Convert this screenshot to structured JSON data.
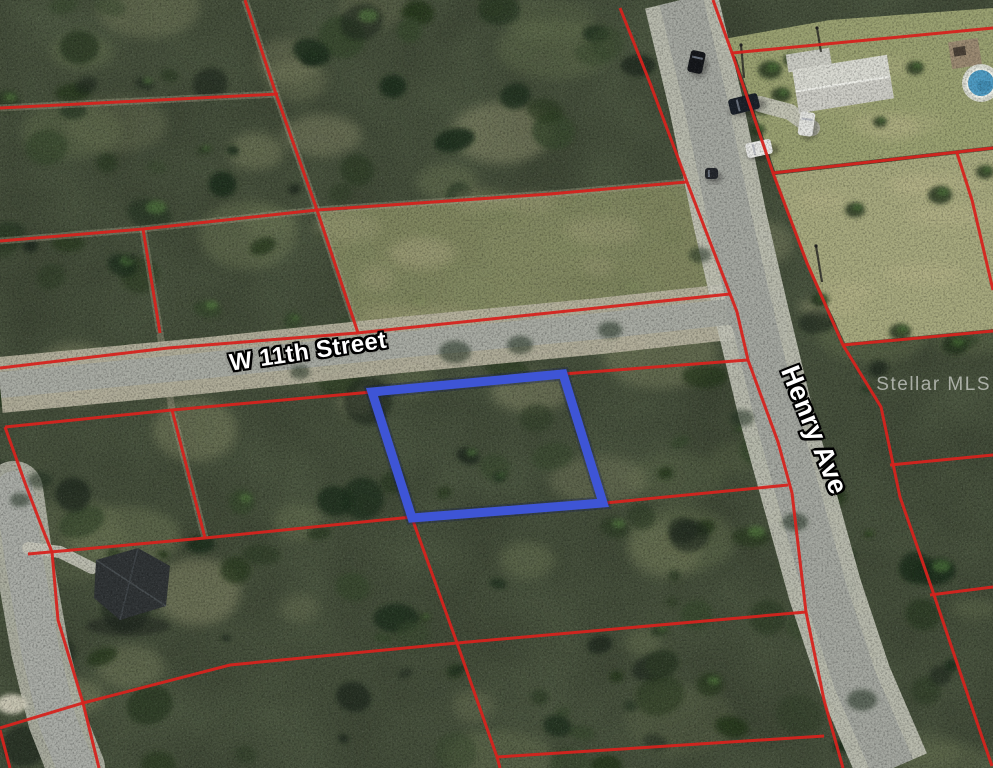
{
  "map": {
    "street_labels": [
      {
        "id": "w-11th-street",
        "text": "W 11th Street"
      },
      {
        "id": "henry-ave",
        "text": "Henry Ave"
      }
    ],
    "watermark": {
      "text": "Stellar MLS"
    },
    "colors": {
      "parcel_line": "#d6231d",
      "highlight": "#3e55d6",
      "highlight_underlay": "#101c4e",
      "forest": "#4c5741",
      "lawn": "#9aa171",
      "mowed": "#a7a97e",
      "midwest_clearing": "#8b9066",
      "pavement": "#a8aba3",
      "henry_pavement": "#a4a7a0",
      "shoulder": "#b9b4a1",
      "henry_shoulder": "#c4c5b9",
      "sw_pavement": "#a9aca6",
      "sw_shoulder": "#bcbdb0",
      "driveway": "#c6c6ba",
      "pool_water": "#4e9cc4",
      "track": "#a7a189"
    },
    "highlight_parcel": [
      [
        372,
        392
      ],
      [
        563,
        374
      ],
      [
        603,
        503
      ],
      [
        412,
        518
      ]
    ],
    "parcel_lines": [
      [
        [
          0,
          108
        ],
        [
          278,
          94
        ]
      ],
      [
        [
          245,
          0
        ],
        [
          276,
          94
        ],
        [
          317,
          210
        ],
        [
          358,
          333
        ]
      ],
      [
        [
          0,
          241
        ],
        [
          143,
          229
        ],
        [
          317,
          210
        ],
        [
          550,
          194
        ],
        [
          686,
          182
        ]
      ],
      [
        [
          143,
          229
        ],
        [
          160,
          333
        ]
      ],
      [
        [
          172,
          410
        ],
        [
          205,
          538
        ]
      ],
      [
        [
          0,
          368
        ],
        [
          168,
          348
        ],
        [
          357,
          333
        ],
        [
          730,
          294
        ]
      ],
      [
        [
          5,
          427
        ],
        [
          172,
          410
        ],
        [
          372,
          392
        ]
      ],
      [
        [
          563,
          374
        ],
        [
          748,
          360
        ]
      ],
      [
        [
          620,
          8
        ],
        [
          650,
          83
        ],
        [
          687,
          182
        ],
        [
          737,
          312
        ],
        [
          748,
          360
        ],
        [
          778,
          442
        ],
        [
          792,
          493
        ],
        [
          806,
          612
        ],
        [
          824,
          700
        ],
        [
          843,
          768
        ]
      ],
      [
        [
          28,
          554
        ],
        [
          205,
          538
        ],
        [
          412,
          517
        ]
      ],
      [
        [
          605,
          503
        ],
        [
          788,
          485
        ]
      ],
      [
        [
          5,
          427
        ],
        [
          25,
          483
        ],
        [
          43,
          530
        ],
        [
          52,
          552
        ],
        [
          58,
          620
        ],
        [
          83,
          703
        ],
        [
          99,
          768
        ]
      ],
      [
        [
          412,
          518
        ],
        [
          457,
          643
        ],
        [
          497,
          757
        ],
        [
          500,
          768
        ]
      ],
      [
        [
          0,
          728
        ],
        [
          83,
          703
        ],
        [
          230,
          665
        ],
        [
          457,
          643
        ],
        [
          806,
          612
        ]
      ],
      [
        [
          497,
          757
        ],
        [
          824,
          736
        ]
      ],
      [
        [
          713,
          0
        ],
        [
          732,
          53
        ],
        [
          773,
          173
        ],
        [
          807,
          263
        ],
        [
          843,
          345
        ],
        [
          881,
          407
        ],
        [
          900,
          497
        ],
        [
          933,
          592
        ],
        [
          983,
          740
        ],
        [
          992,
          766
        ]
      ],
      [
        [
          732,
          53
        ],
        [
          993,
          28
        ]
      ],
      [
        [
          773,
          173
        ],
        [
          993,
          148
        ]
      ],
      [
        [
          843,
          345
        ],
        [
          993,
          331
        ]
      ],
      [
        [
          890,
          465
        ],
        [
          993,
          455
        ]
      ],
      [
        [
          930,
          595
        ],
        [
          993,
          587
        ]
      ],
      [
        [
          957,
          153
        ],
        [
          972,
          200
        ],
        [
          993,
          290
        ]
      ],
      [
        [
          0,
          730
        ],
        [
          10,
          768
        ]
      ]
    ],
    "cleared_tracks": [
      [
        [
          245,
          0
        ],
        [
          276,
          94
        ],
        [
          317,
          210
        ],
        [
          358,
          333
        ]
      ],
      [
        [
          143,
          229
        ],
        [
          160,
          333
        ],
        [
          172,
          410
        ],
        [
          205,
          538
        ]
      ],
      [
        [
          0,
          108
        ],
        [
          278,
          94
        ]
      ],
      [
        [
          0,
          241
        ],
        [
          143,
          229
        ],
        [
          317,
          210
        ],
        [
          550,
          194
        ],
        [
          686,
          182
        ]
      ]
    ],
    "roads": {
      "henry": [
        [
          681,
          0
        ],
        [
          705,
          100
        ],
        [
          730,
          220
        ],
        [
          752,
          315
        ],
        [
          775,
          410
        ],
        [
          800,
          500
        ],
        [
          825,
          590
        ],
        [
          855,
          680
        ],
        [
          893,
          768
        ]
      ],
      "w11th": [
        [
          0,
          385
        ],
        [
          200,
          366
        ],
        [
          400,
          345
        ],
        [
          600,
          326
        ],
        [
          755,
          309
        ]
      ],
      "sw": [
        [
          14,
          490
        ],
        [
          24,
          560
        ],
        [
          40,
          650
        ],
        [
          57,
          720
        ],
        [
          76,
          768
        ]
      ]
    },
    "areas": {
      "lawn": [
        [
          718,
          40
        ],
        [
          830,
          20
        ],
        [
          993,
          8
        ],
        [
          993,
          146
        ],
        [
          775,
          171
        ],
        [
          736,
          57
        ]
      ],
      "mowed": [
        [
          775,
          175
        ],
        [
          993,
          150
        ],
        [
          993,
          329
        ],
        [
          845,
          343
        ],
        [
          809,
          265
        ]
      ],
      "midwest": [
        [
          319,
          212
        ],
        [
          684,
          184
        ],
        [
          728,
          293
        ],
        [
          359,
          331
        ]
      ]
    },
    "features": {
      "house_ne": {
        "cx": 843,
        "cy": 84,
        "x": 795,
        "y": 62,
        "w": 96,
        "h": 44,
        "rot": -9
      },
      "carport_ne": {
        "x": 791,
        "y": 46,
        "w": 44,
        "h": 18
      },
      "shed_ne": {
        "x": 950,
        "y": 40,
        "w": 30,
        "h": 27,
        "rot": -9
      },
      "pool": {
        "cx": 981,
        "cy": 83,
        "r": 14
      },
      "house_sw": [
        [
          96,
          560
        ],
        [
          138,
          548
        ],
        [
          170,
          566
        ],
        [
          166,
          606
        ],
        [
          120,
          620
        ],
        [
          94,
          598
        ]
      ],
      "cars": [
        {
          "x": 689,
          "y": 51,
          "w": 15,
          "h": 22,
          "rot": 12,
          "color": "#15171b"
        },
        {
          "x": 729,
          "y": 96,
          "w": 30,
          "h": 16,
          "rot": -14,
          "color": "#1a2029"
        },
        {
          "x": 746,
          "y": 141,
          "w": 26,
          "h": 15,
          "rot": -12,
          "color": "#e8e9e6"
        },
        {
          "x": 799,
          "y": 112,
          "w": 15,
          "h": 24,
          "rot": 8,
          "color": "#e4e5e1"
        },
        {
          "x": 705,
          "y": 168,
          "w": 13,
          "h": 11,
          "rot": 0,
          "color": "#23262b"
        }
      ],
      "poles": [
        [
          [
            741,
            45
          ],
          [
            744,
            78
          ]
        ],
        [
          [
            817,
            28
          ],
          [
            821,
            52
          ]
        ],
        [
          [
            816,
            246
          ],
          [
            822,
            282
          ]
        ]
      ],
      "driveways": [
        {
          "pts": [
            [
              760,
              104
            ],
            [
              790,
              112
            ],
            [
              812,
              128
            ]
          ],
          "w": 16
        },
        {
          "pts": [
            [
              28,
              548
            ],
            [
              60,
              552
            ],
            [
              92,
              568
            ]
          ],
          "w": 12
        }
      ],
      "sand_patch": {
        "cx": 12,
        "cy": 704,
        "rx": 15,
        "ry": 10
      }
    }
  }
}
